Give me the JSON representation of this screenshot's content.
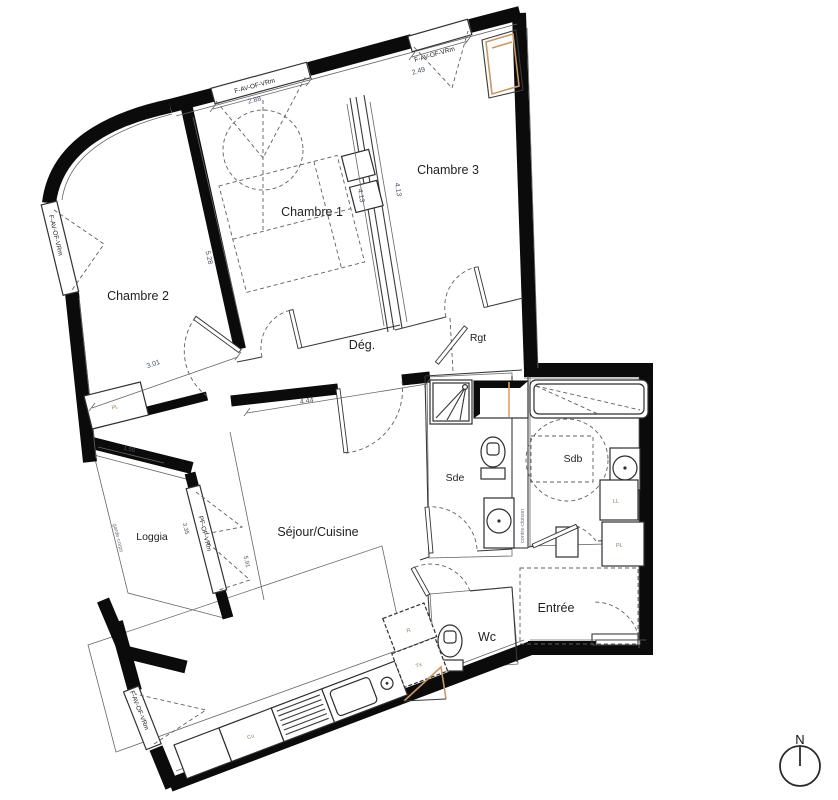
{
  "rooms": {
    "chambre1": "Chambre 1",
    "chambre2": "Chambre 2",
    "chambre3": "Chambre 3",
    "degagement": "Dég.",
    "rangement": "Rgt",
    "sde": "Sde",
    "sdb": "Sdb",
    "sejour": "Séjour/Cuisine",
    "loggia": "Loggia",
    "entree": "Entrée",
    "wc": "Wc"
  },
  "windows": {
    "facade": "F-AV-OF-VRm",
    "loggia_door": "PF-OF-VRm"
  },
  "dimensions": {
    "top_window": "2.88",
    "top_right_window": "2.49",
    "chambre1_depth": "4.13",
    "chambre3_depth": "4.13",
    "chambre2_length": "5.28",
    "chambre2_width": "3.01",
    "sejour_width": "4.44",
    "loggia_width": "1.50",
    "loggia_length": "3.35",
    "sejour_length": "5.91"
  },
  "annotations": {
    "contre_cloison": "contre-cloison",
    "garde_corps": "garde-corps",
    "closet": "PL",
    "washing_machine": "LL",
    "cooktop": "Cu",
    "fridge": "R",
    "tx": "Tx"
  },
  "compass": {
    "north": "N"
  },
  "colors": {
    "wall": "#0b0b0b",
    "tile_line": "#c2c2c2",
    "dimension_text": "#44546a",
    "accent_wood": "#cd9660",
    "small_label": "#9b7b58"
  }
}
